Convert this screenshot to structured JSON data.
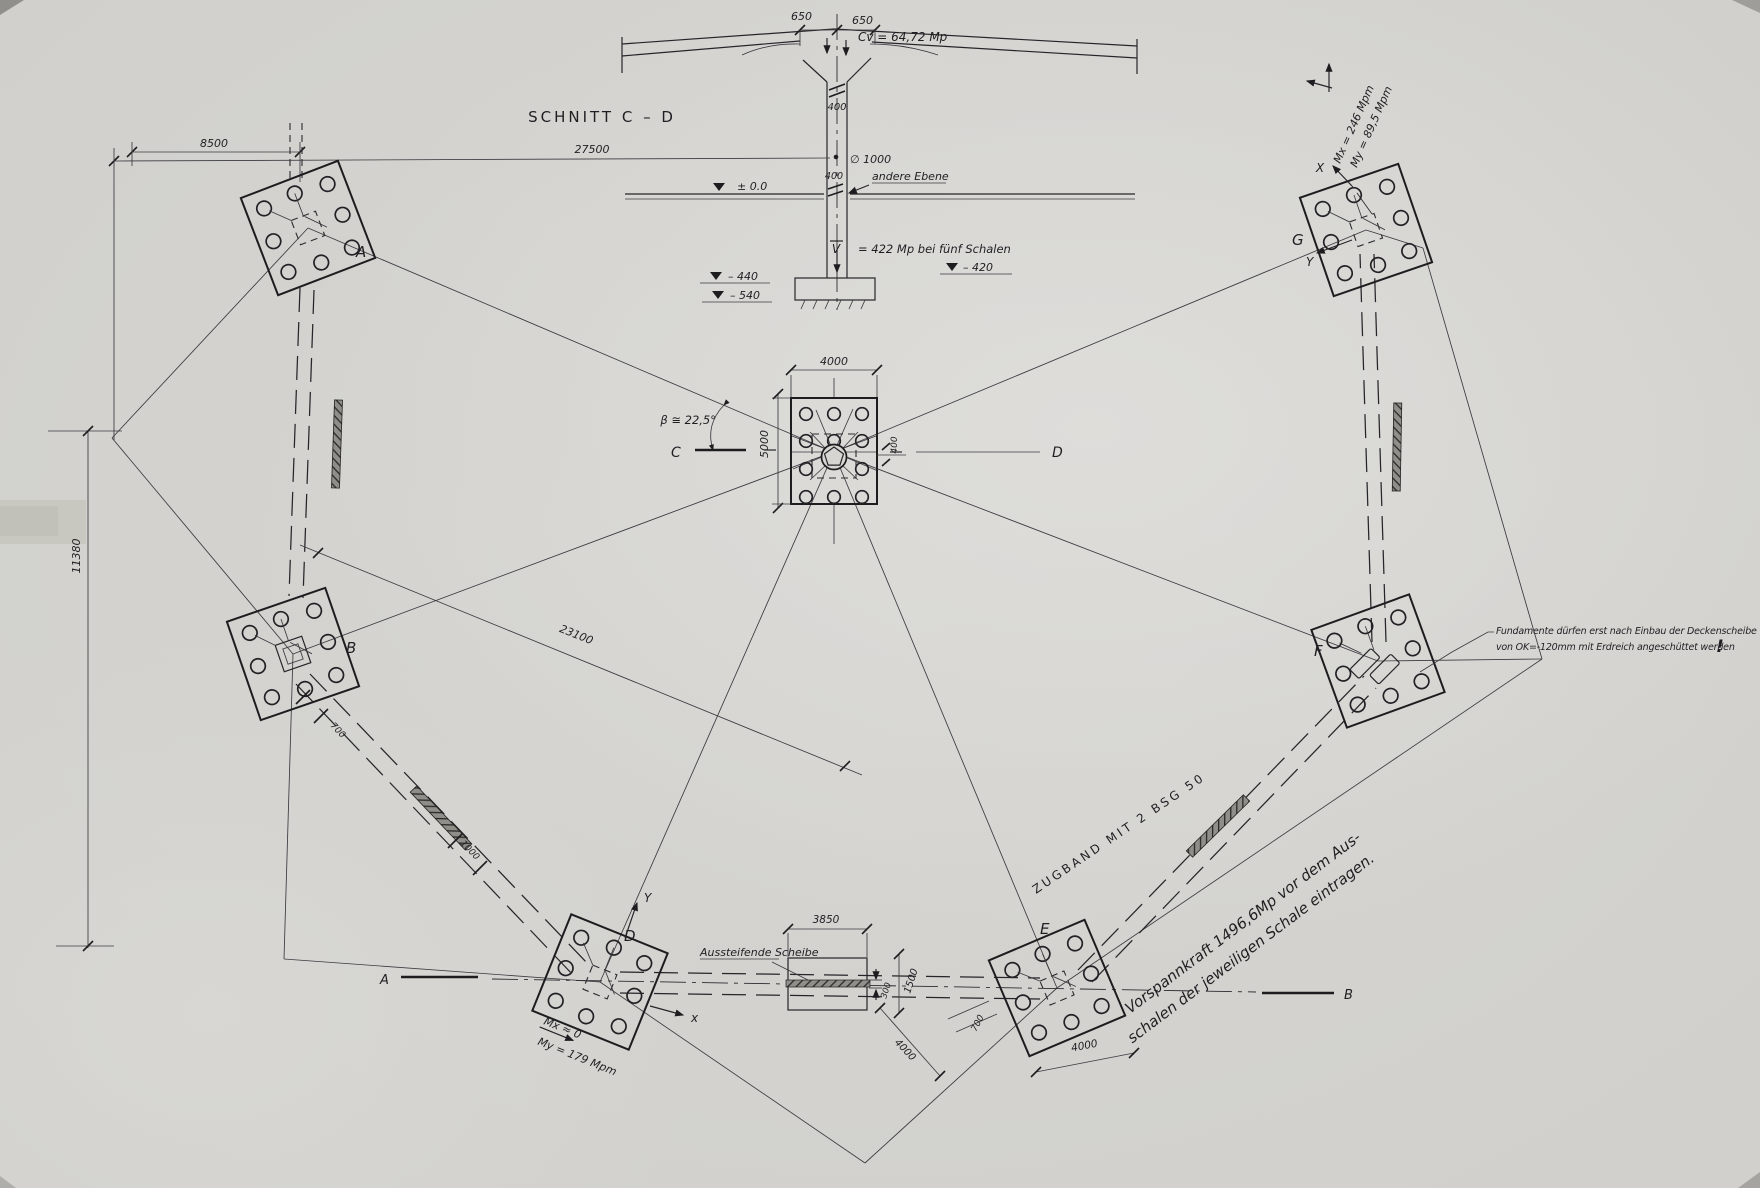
{
  "colors": {
    "paper": "#d5d4d0",
    "ink": "#1f1f23",
    "band": "#8f8e88"
  },
  "section": {
    "title": "SCHNITT  C – D",
    "dim_650_left": "650",
    "dim_650_right": "650",
    "load_cv": "Cv = 64,72 Mp",
    "dim_400_upper": "400",
    "dim_400_lower": "400",
    "dim_27500": "27500",
    "dim_8500": "8500",
    "dia_1000": "∅ 1000",
    "andere_ebene": "andere Ebene",
    "level_zero": "± 0.0",
    "v_label": "V",
    "v_value": "= 422 Mp bei fünf Schalen",
    "level_m440": "– 440",
    "level_m540": "– 540",
    "level_m420": "– 420"
  },
  "plan": {
    "footings": {
      "a": "A",
      "b": "B",
      "d": "D",
      "e": "E",
      "f": "F",
      "g": "G"
    },
    "cuts": {
      "c": "C",
      "d": "D",
      "a": "A",
      "b": "B"
    },
    "center_dims": {
      "width": "4000",
      "height": "5000",
      "offset": "400",
      "angle": "β ≅ 22,5°"
    },
    "dim_23100": "23100",
    "dim_11380": "11380",
    "dim_700_b": "700",
    "dim_1000": "1000",
    "scheibe_label": "Aussteifende Scheibe",
    "dim_3850": "3850",
    "dim_300": "300",
    "dim_1500": "1500",
    "dim_4000_diag": "4000",
    "dim_700_e": "700",
    "dim_4000_e": "4000",
    "zugband": "ZUGBAND  MIT  2  BSG  50",
    "vorspann_line1": "Vorspannkraft  1496,6Mp  vor  dem  Aus-",
    "vorspann_line2": "schalen  der  jeweiligen  Schale  eintragen.",
    "moments_d": {
      "mx": "Mx ≈ 0",
      "my": "My = 179 Mpm"
    },
    "moments_g": {
      "mx": "Mx = 246 Mpm",
      "my": "My = 89,5 Mpm"
    },
    "axes": {
      "d_x": "x",
      "d_y": "Y",
      "g_x": "X",
      "g_y": "Y"
    },
    "note_line1": "Fundamente dürfen erst nach Einbau der Deckenscheibe",
    "note_line2": "von OK=-120mm mit Erdreich angeschüttet werden",
    "note_bang": "!"
  }
}
